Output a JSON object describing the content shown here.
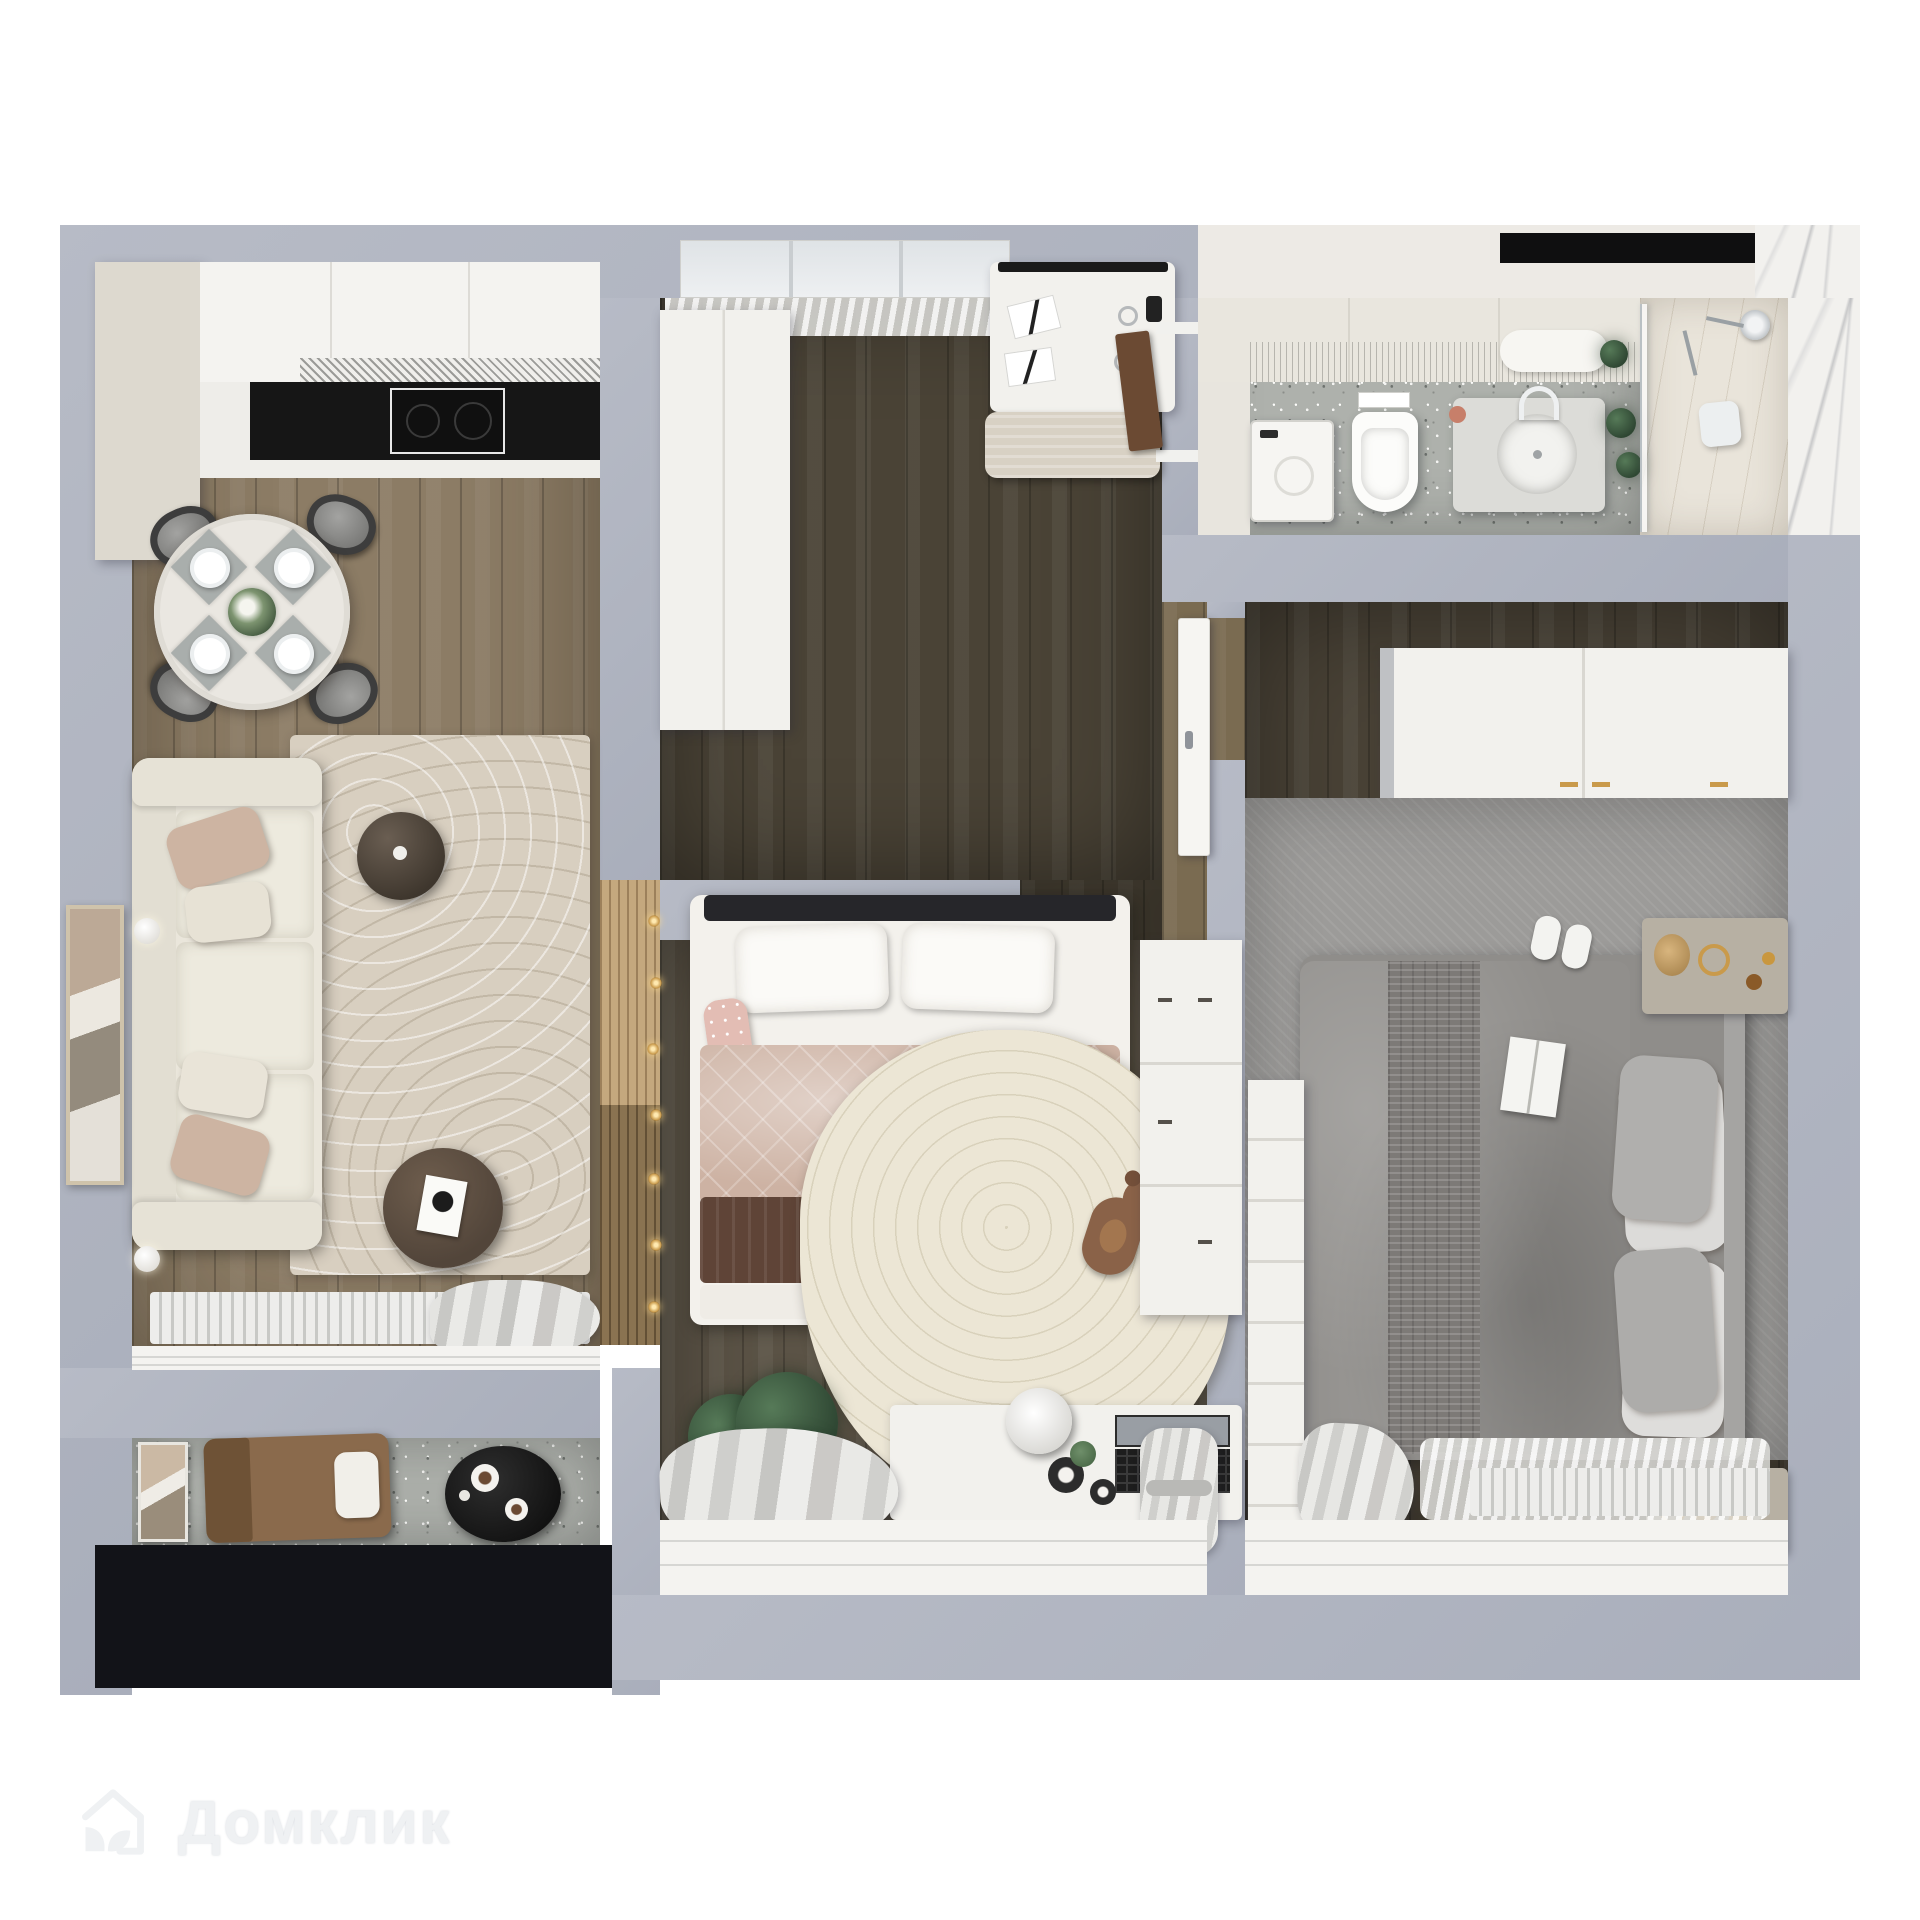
{
  "watermark": {
    "brand": "Домклик",
    "logo": "house-leaf-logo-icon"
  },
  "palette": {
    "wall": "#b7bbc6",
    "wall-shadow": "#a9aebb",
    "wood-living": "#8c7c65",
    "wood-kids-up": "#4a4336",
    "wood-kids-low": "#5b5346",
    "wood-corridor": "#7a6b51",
    "wood-bedroom": "#494236",
    "terrazzo": "#aeb1ac",
    "marble": "#f2f1ee",
    "white-furn": "#f2f1ed",
    "counter-black": "#161616",
    "cabinet-beige": "#ddd9cf",
    "sofa-cream": "#eae6db",
    "rug-living": "#d8cfc0",
    "rug-kids": "#ece6d5",
    "carpet": "#9c9b99",
    "quilt": "#cdb2a3",
    "blanket-brown": "#5f4437",
    "bed-gray": "#8f8d8a",
    "lounge-brown": "#8a6a4c",
    "glass-frame": "#121318",
    "gold": "#c99a4b",
    "plant": "#3c5540"
  },
  "scene": {
    "type": "3d-floorplan-top-down-render",
    "rooms": [
      {
        "name": "kitchen-living-room",
        "items": [
          "tall-cabinet",
          "kitchen-counter",
          "black-countertop",
          "cooktop",
          "dining-table",
          "dining-chairs-x4",
          "plates-x4",
          "flower-centerpiece",
          "cream-sofa",
          "throw-pillows",
          "side-table",
          "coffee-table",
          "magazine",
          "arc-pattern-rug",
          "wall-art",
          "wall-sconces-x2",
          "radiator",
          "curtain",
          "window-sill"
        ]
      },
      {
        "name": "kids-room-study-zone",
        "items": [
          "window",
          "sheer-curtain",
          "wardrobe",
          "desk",
          "papers",
          "reading-glasses",
          "desk-lamp",
          "bench",
          "bathroom-door"
        ]
      },
      {
        "name": "kids-room-sleep-zone",
        "items": [
          "single-bed",
          "pillows",
          "pink-quilt",
          "brown-blanket",
          "fairy-lights",
          "wood-slat-headboard-wall",
          "organic-cream-rug",
          "teddy-bear",
          "dresser",
          "study-desk",
          "laptop",
          "tulip-chair",
          "jars-x2",
          "floor-plant",
          "curtains",
          "window-sill"
        ]
      },
      {
        "name": "bathroom",
        "items": [
          "counter-cabinets",
          "washing-machine",
          "wall-hung-toilet",
          "flush-plate",
          "vanity",
          "round-sink",
          "faucet",
          "soap-dispenser",
          "mirror-shelf",
          "plants",
          "mirror-strip",
          "glass-shower-partition",
          "shower-set",
          "marble-wall"
        ]
      },
      {
        "name": "bedroom",
        "items": [
          "wardrobe",
          "herringbone-carpet",
          "double-bed",
          "gray-duvet",
          "knit-throw",
          "open-book",
          "pillows-x4",
          "upholstered-headboard",
          "slippers",
          "nightstand-with-decor-x2",
          "gold-rings",
          "dried-flowers",
          "tv-panel",
          "curtain",
          "sheer",
          "radiator",
          "window-sill"
        ]
      },
      {
        "name": "hallway",
        "items": [
          "open-white-door",
          "wood-floor"
        ]
      },
      {
        "name": "balcony",
        "items": [
          "leaning-artwork",
          "lounge-chair",
          "white-pillow",
          "black-oval-table",
          "coffee-cups-x2",
          "panoramic-glazing"
        ]
      }
    ]
  }
}
